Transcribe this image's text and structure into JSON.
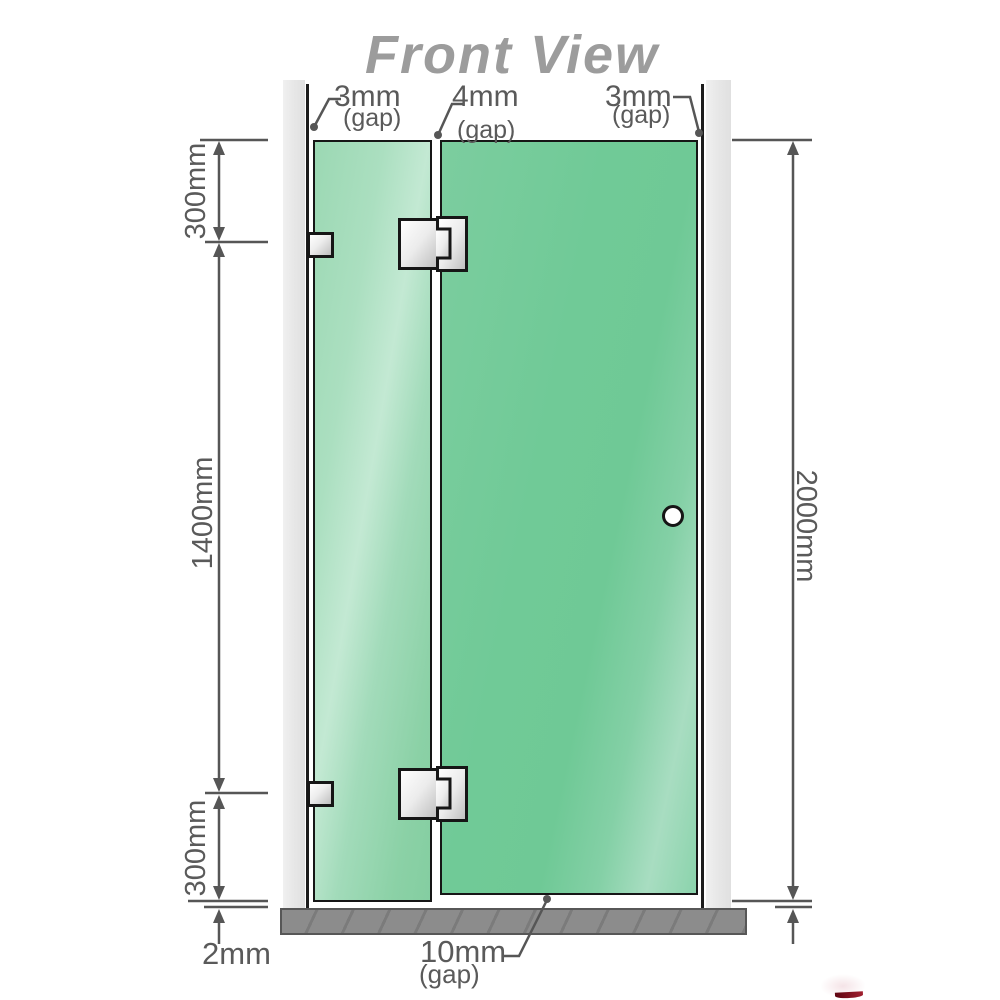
{
  "title": "Front View",
  "diagram": {
    "type": "shower-screen-front-view-dimension-drawing",
    "top_gaps": [
      {
        "id": "wall-to-fixed-panel",
        "value": "3mm",
        "label": "(gap)"
      },
      {
        "id": "fixed-panel-to-door",
        "value": "4mm",
        "label": "(gap)"
      },
      {
        "id": "door-to-wall",
        "value": "3mm",
        "label": "(gap)"
      }
    ],
    "side_dimensions": {
      "left_top": "300mm",
      "left_middle": "1400mm",
      "left_bottom": "300mm",
      "right": "2000mm"
    },
    "bottom": {
      "floor_gap": "2mm",
      "door_gap_value": "10mm",
      "door_gap_label": "(gap)"
    }
  },
  "colors": {
    "title_gray": "#9c9c9c",
    "glass_door_green": "#70ca97",
    "glass_fixed_green": "#9bd8b3",
    "wall_gray": "#e8e8e8",
    "floor_gray": "#8c8c8c",
    "outline_black": "#161616",
    "dimension_gray": "#565656",
    "hardware_silver": "#d9d9d9",
    "logo_red": "#8b1021"
  }
}
